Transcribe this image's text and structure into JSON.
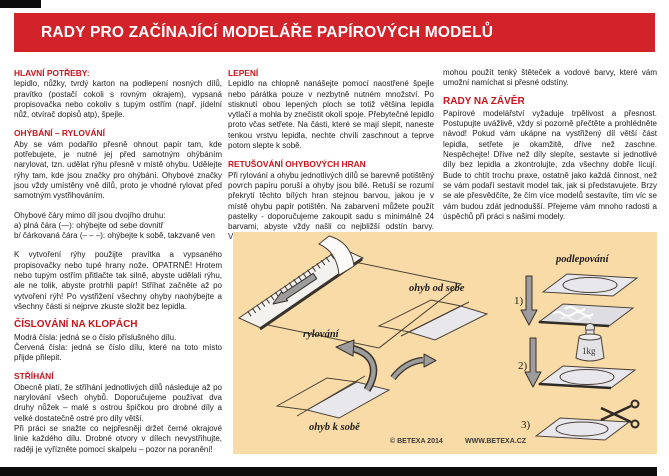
{
  "title": "RADY PRO ZAČÍNAJÍCÍ MODELÁŘE PAPÍROVÝCH MODELŮ",
  "colors": {
    "banner_red": "#d2232a",
    "heading_red": "#c4161c",
    "illustration_bg": "#f8dba6",
    "body_text": "#1d1d1d",
    "bar_black": "#0c0c0c"
  },
  "col1": {
    "s1": {
      "heading": "HLAVNÍ POTŘEBY:",
      "p1": "lepidlo, nůžky, tvrdý karton na podlepení nosných dílů, pravítko (postačí cokoli s rovným okrajem), vypsaná propisovačka nebo cokoliv s tupým ostřím (např. jídelní nůž, otvírač dopisů atp), špejle."
    },
    "s2": {
      "heading": "OHÝBÁNÍ – RYLOVÁNÍ",
      "p1": "Aby se vám podařilo přesně ohnout papír tam, kde potřebujete, je nutné jej před samotným ohýbáním narylovat, tzn. udělat rýhu přesně v místě ohybu. Udělejte rýhy tam, kde jsou značky pro ohýbání. Ohybové značky jsou vždy umístěny vně dílů, proto je vhodné rylovat před samotným vystřihováním.",
      "list_intro": "Ohybové čáry mimo díl jsou dvojího druhu:",
      "item_a": "a) plná čára (—): ohýbejte od sebe dovnitř",
      "item_b": "b/ čárkovaná čára (– – –): ohýbejte k sobě, takzvaně ven",
      "p2": "K vytvoření rýhy použijte pravítka a vypsaného propisovačky nebo tupé hrany nože. OPATRNĚ! Hrotem nebo tupým ostřím přitlačte tak silně, abyste udělali rýhu, ale ne tolik, abyste protrhli papír! Stříhat začněte až po vytvoření rýh! Po vystřižení všechny ohyby naohýbejte a všechny části si nejprve zkuste složit bez lepidla."
    },
    "s3": {
      "heading": "ČÍSLOVÁNÍ NA KLOPÁCH",
      "line1": "Modrá čísla: jedná se o číslo příslušného dílu.",
      "line2": "Červená čísla: jedná se číslo dílu, které na toto místo přijde přilepit."
    },
    "s4": {
      "heading": "STŘÍHÁNÍ",
      "p1": "Obecně platí, že stříhání jednotlivých dílů následuje až po narylování všech ohybů. Doporučujeme používat dva druhy nůžek – malé s ostrou špičkou pro drobné díly a velké dostatečně ostré pro díly větší.",
      "p2": "Při práci se snažte co nejpřesněji držet černé okrajové linie každého dílu. Drobné otvory v dílech nevystřihujte, raději je vyřízněte pomocí skalpelu – pozor na poranění!"
    }
  },
  "col2": {
    "s1": {
      "heading": "LEPENÍ",
      "p1": "Lepidlo na chlopně nanášejte pomocí naostřené špejle nebo párátka pouze v nezbytně nutném množství. Po stisknutí obou lepených ploch se totiž většina lepidla vytlačí a mohla by znečistit okolí spoje. Přebytečné lepidlo proto včas setřete. Na části, které se mají slepit, naneste tenkou vrstvu lepidla, nechte chvíli zaschnout a teprve potom slepte k sobě."
    },
    "s2": {
      "heading": "RETUŠOVÁNÍ OHYBOVÝCH HRAN",
      "p1": "Při rylování a ohybu jednotlivých dílů se barevně potištěný povrch papíru poruší a ohyby jsou bílé. Retuší se rozumí překrytí těchto bílých hran stejnou barvou, jakou je v místě ohybu papír potištěn. Na zabarvení můžete použít pastelky - doporučujeme zakoupit sadu s minimálně 24 barvami, abyste vždy našli co nejbližší odstín barvy. Vyspělejší modeláři"
    }
  },
  "col3": {
    "p0": "mohou použít tenký štěteček a vodové barvy, které vám umožní namíchat si přesné odstíny.",
    "s1": {
      "heading": "RADY NA ZÁVĚR",
      "p1": "Papírové modelářství vyžaduje trpělivost a přesnost. Postupujte uvážlivě, vždy si pozorně přečtěte a prohlédněte návod! Pokud vám ukápne na vystřižený díl větší část lepidla, setřete je okamžitě, dříve než zaschne. Nespěchejte! Dříve než díly slepíte, sestavte si jednotlivé díly bez lepidla a zkontrolujte, zda všechny dobře lícují. Bude to chtít trochu praxe, ostatně jako každá činnost, než se vám podaří sestavit model tak, jak si představujete. Brzy se ale přesvědčíte, že čím více modelů sestavíte, tím víc se vám budou zdát jednodušší. Přejeme vám mnoho radosti a úspěchů při práci s našimi modely."
    }
  },
  "illustration": {
    "label_rylovani": "rylování",
    "label_ohyb_od_sebe": "ohyb od sebe",
    "label_ohyb_k_sobe": "ohyb k sobě",
    "label_podlepovani": "podlepování",
    "step1": "1)",
    "step2": "2)",
    "step3": "3)",
    "weight_label": "1kg",
    "copyright": "© BETEXA 2014",
    "website": "WWW.BETEXA.CZ"
  }
}
